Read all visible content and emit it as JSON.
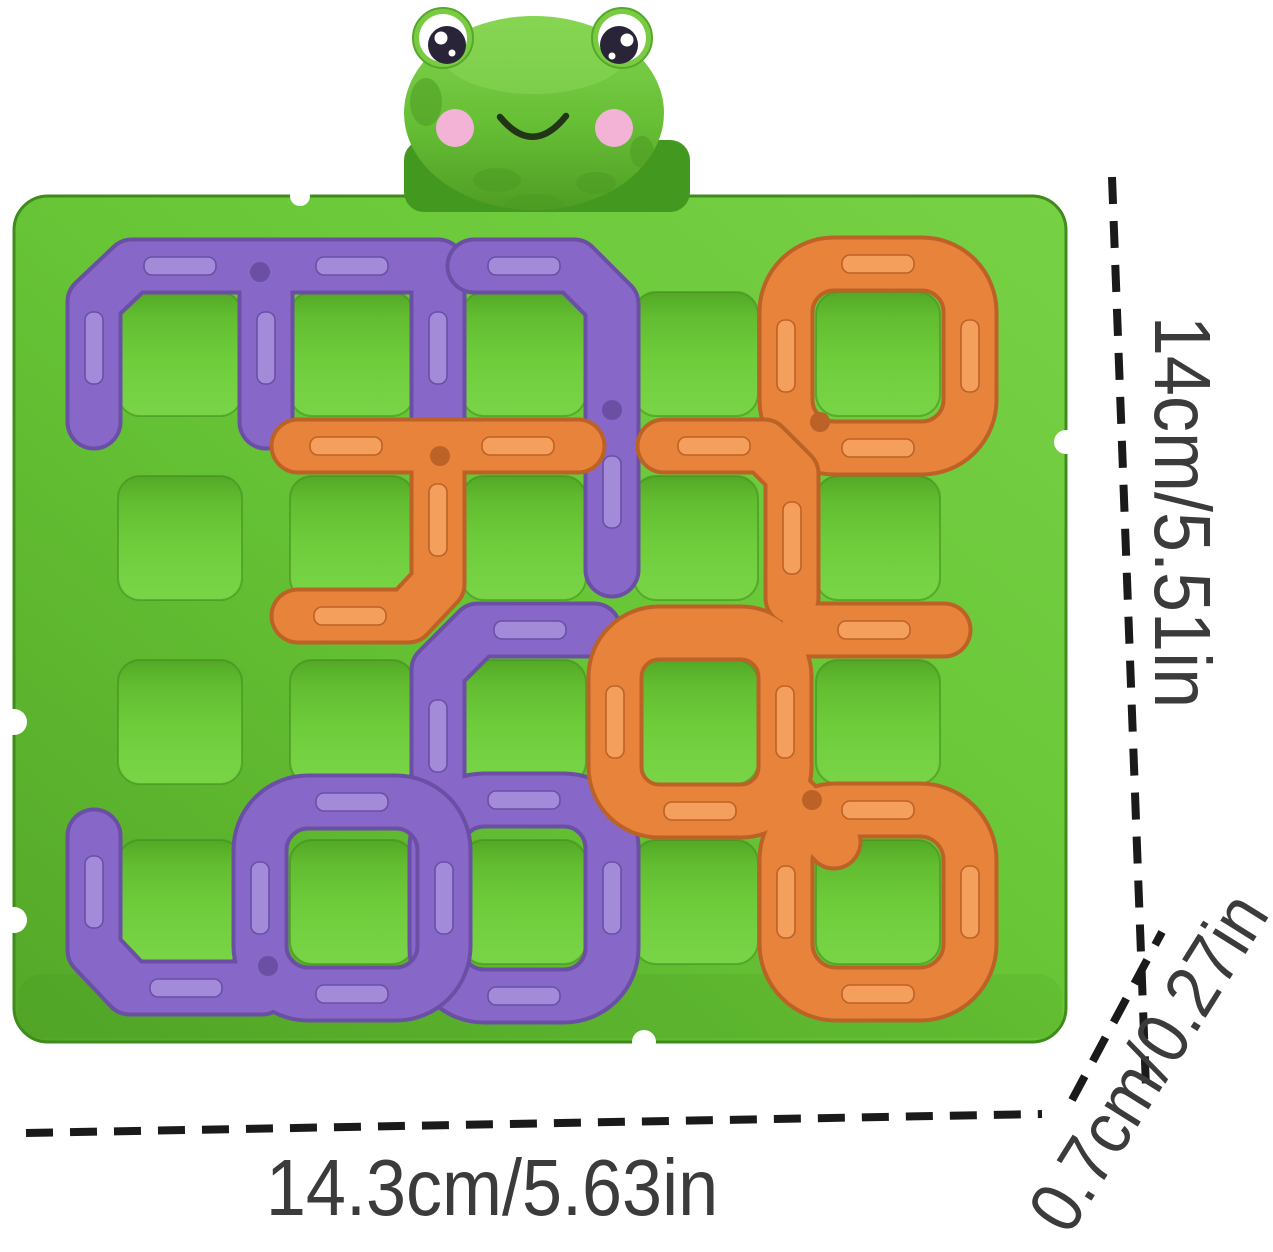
{
  "figure": {
    "subject": "frog maze puzzle board",
    "board": {
      "rows": 4,
      "columns": 5,
      "piece_colors": [
        "purple",
        "orange"
      ],
      "mascot": "smiling frog"
    }
  },
  "dimensions": {
    "height": "14cm/5.51in",
    "width": "14.3cm/5.63in",
    "depth": "0.7cm/0.27in"
  },
  "colors": {
    "background": "#ffffff",
    "board-green": "#6CC93A",
    "board-green-dark": "#54A828",
    "piece-purple": "#8768C8",
    "piece-purple-light": "#A48BDA",
    "piece-purple-dark": "#6A4FA5",
    "piece-orange": "#E8833C",
    "piece-orange-light": "#F4A05C",
    "piece-orange-dark": "#BC6226",
    "frog-banner-green": "#43981F",
    "cheek-pink": "#F3B3D7",
    "eye-dark": "#2A2438",
    "dimension-line": "#1A1A1A",
    "dimension-text": "#3B3B3B"
  }
}
